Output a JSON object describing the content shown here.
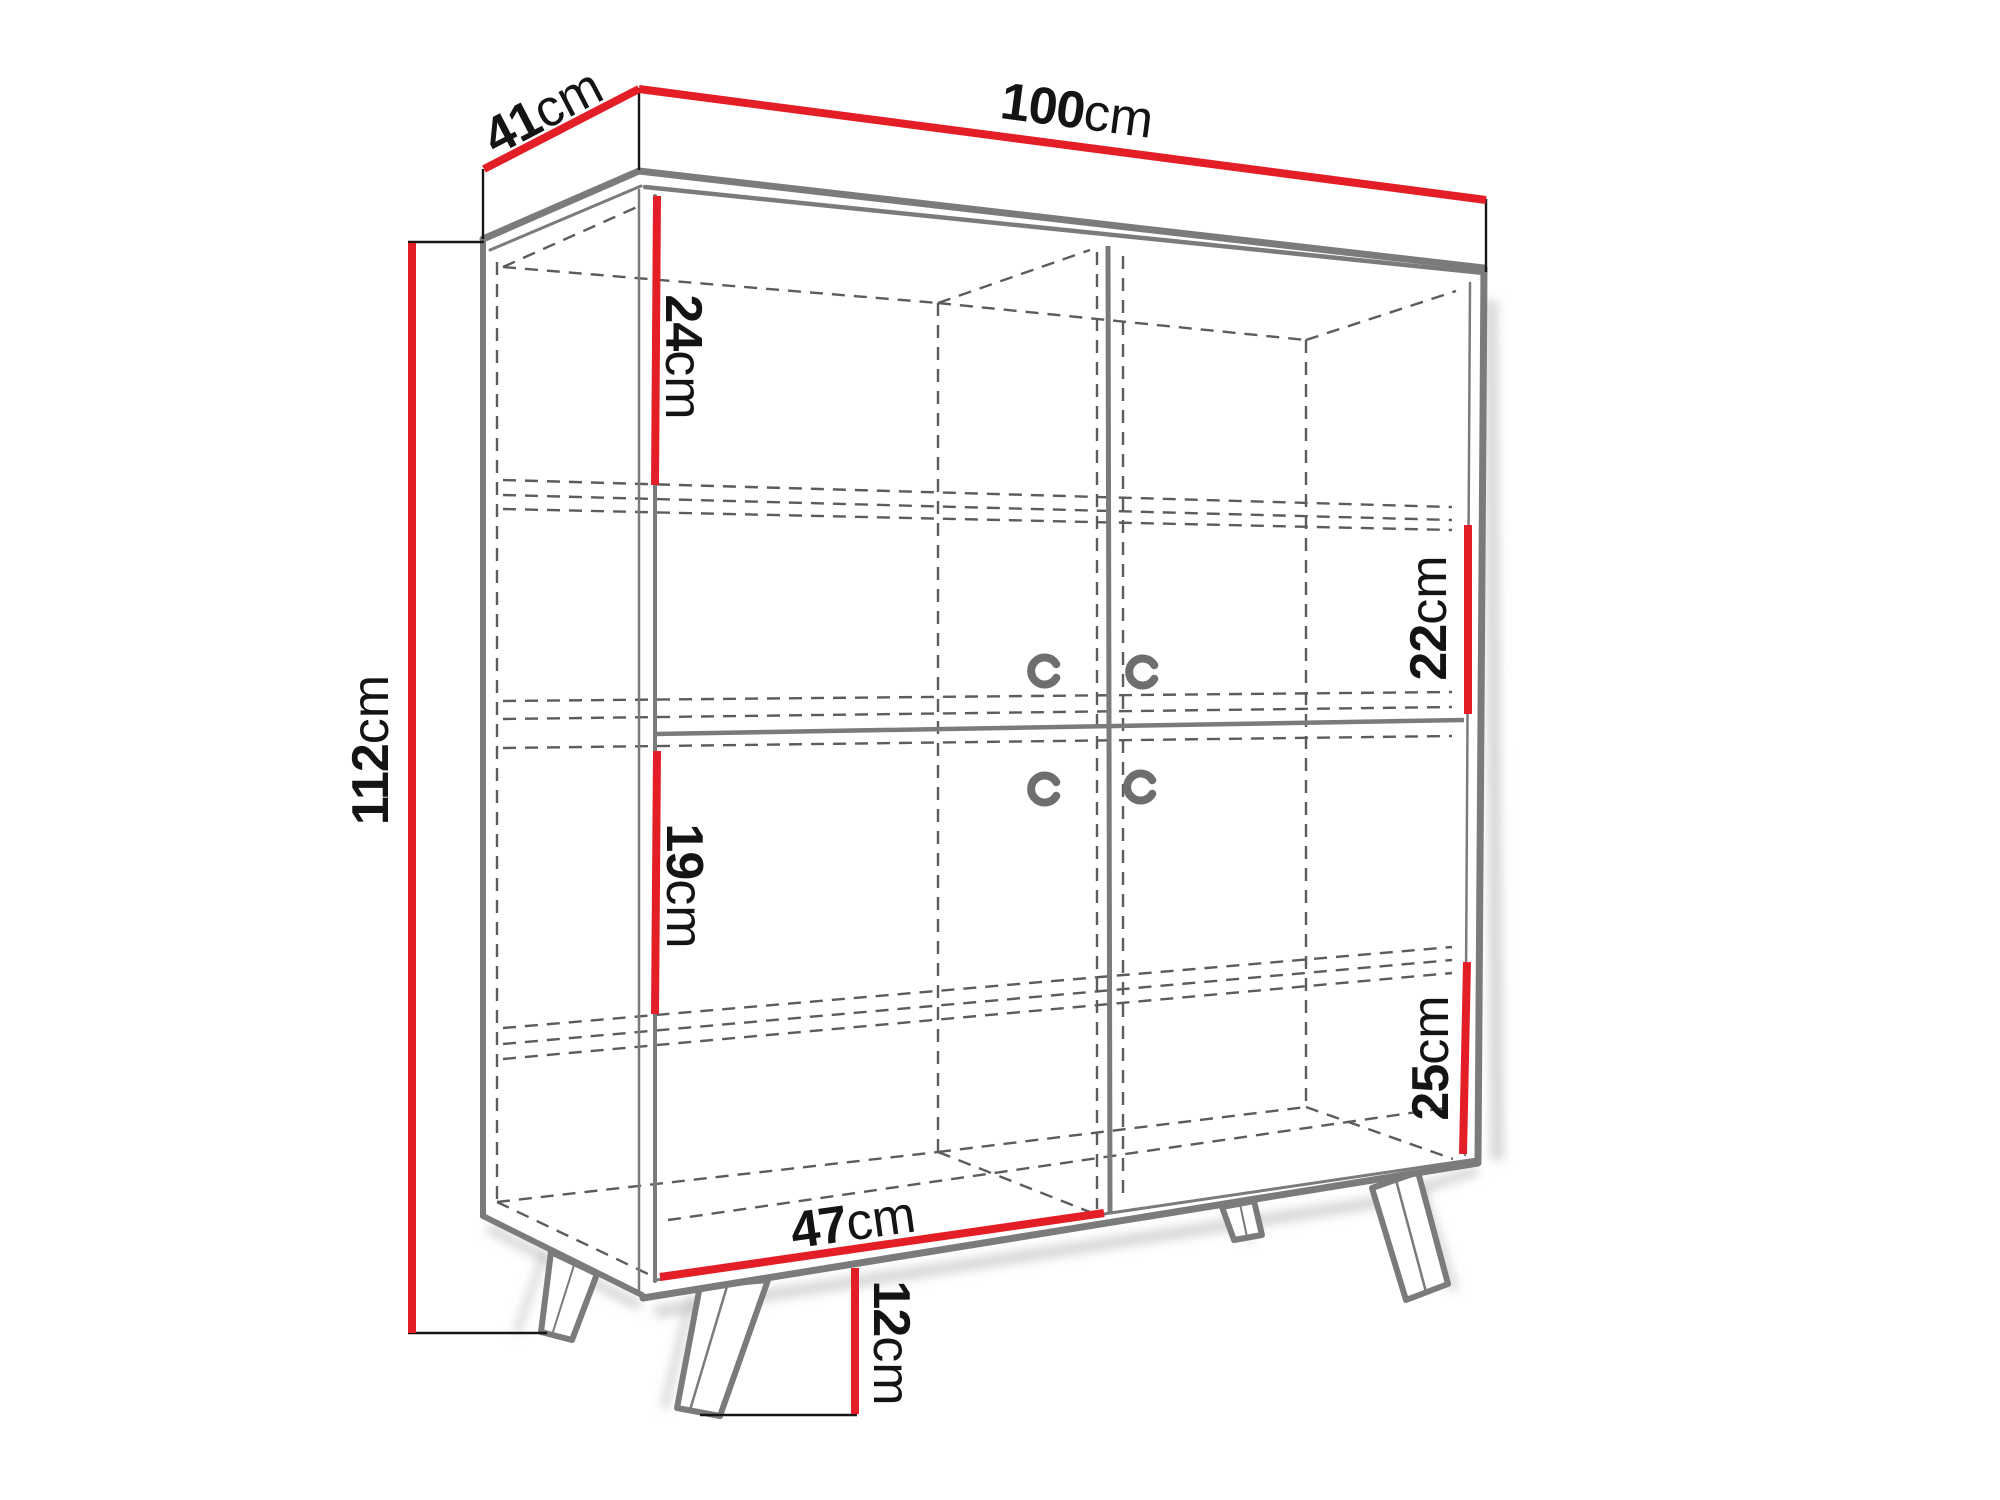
{
  "diagram": {
    "type": "furniture-dimension-diagram",
    "subject": "two-door sideboard cabinet with splayed legs, internal shelves shown dashed",
    "accent_color": "#e41e26",
    "outline_color": "#7b7b7b",
    "hidden_line_color": "#5c5c5c",
    "text_color": "#141414",
    "dimensions": [
      {
        "id": "depth",
        "value": "41",
        "unit": "cm"
      },
      {
        "id": "width",
        "value": "100",
        "unit": "cm"
      },
      {
        "id": "height",
        "value": "112",
        "unit": "cm"
      },
      {
        "id": "top-left-compartment",
        "value": "24",
        "unit": "cm"
      },
      {
        "id": "upper-right-compartment",
        "value": "22",
        "unit": "cm"
      },
      {
        "id": "middle-left-compartment",
        "value": "19",
        "unit": "cm"
      },
      {
        "id": "lower-right-compartment",
        "value": "25",
        "unit": "cm"
      },
      {
        "id": "door-width",
        "value": "47",
        "unit": "cm"
      },
      {
        "id": "leg-height",
        "value": "12",
        "unit": "cm"
      }
    ]
  }
}
